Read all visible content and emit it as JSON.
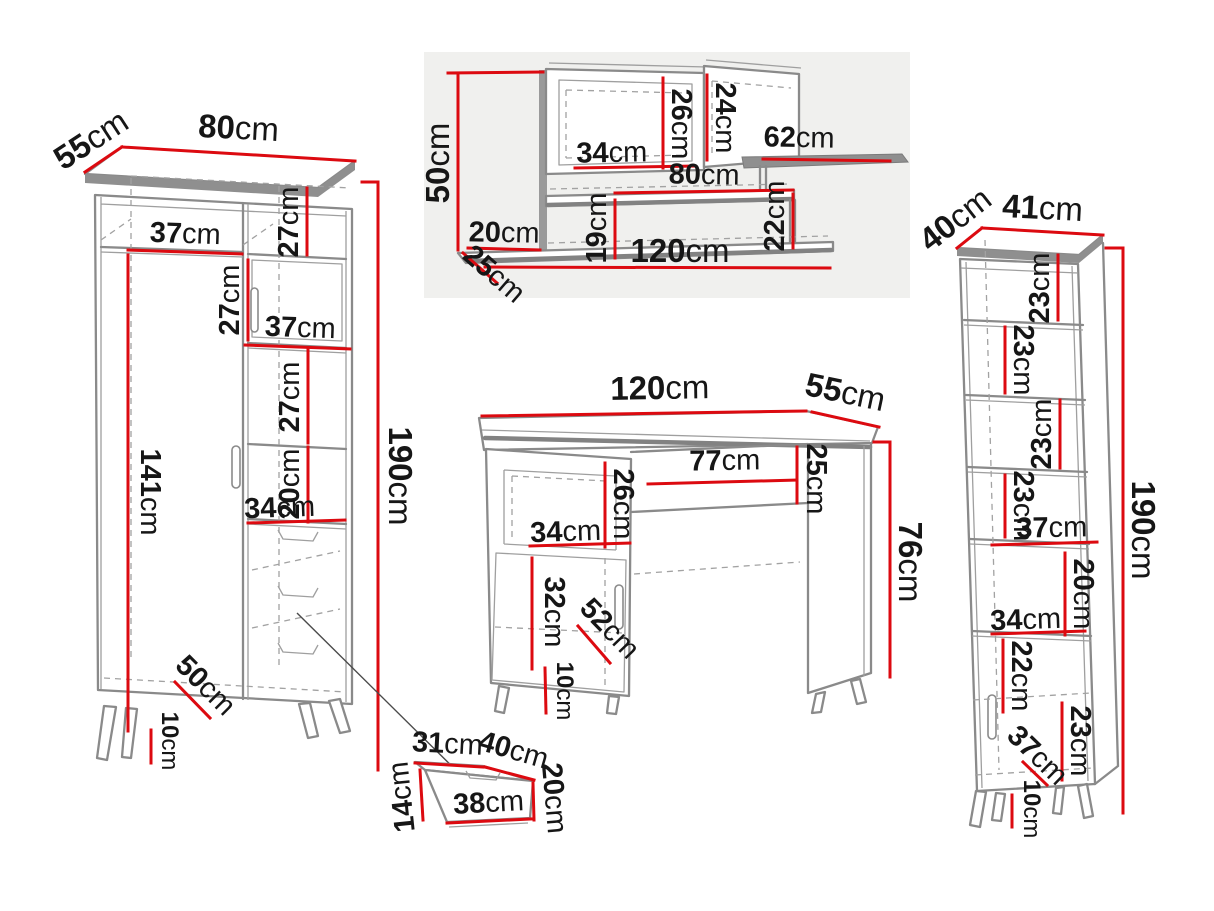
{
  "unit": "cm",
  "colors": {
    "dimension": "#dc0a10",
    "outline": "#8a8a8a",
    "text": "#161616",
    "background": "#ffffff"
  },
  "wardrobe": {
    "depth": "55",
    "width": "80",
    "height": "190",
    "shelf_top_width": "37",
    "top_right_section": "27",
    "mid_door_section": "27",
    "shelf_mid_width": "37",
    "lower_right_section": "27",
    "niche_height": "20",
    "niche_width": "34",
    "left_section_height": "141",
    "base_depth": "50",
    "leg_height": "10"
  },
  "wall_shelf": {
    "height": "50",
    "left_overhang": "20",
    "depth": "25",
    "cabinet_width": "34",
    "cabinet_height": "26",
    "right_cabinet_height": "24",
    "top_shelf_width": "62",
    "middle_shelf_width": "80",
    "left_gap_height": "19",
    "right_gap_height": "22",
    "total_width": "120"
  },
  "desk": {
    "width": "120",
    "depth": "55",
    "height": "76",
    "knee_width": "77",
    "rail_height": "25",
    "niche_height": "26",
    "niche_width": "34",
    "door_height": "32",
    "door_diagonal": "52",
    "leg_height": "10"
  },
  "bookcase": {
    "depth": "40",
    "width": "41",
    "height": "190",
    "section1": "23",
    "section2": "23",
    "section3": "23",
    "section4": "23",
    "shelf_width": "37",
    "niche_height": "20",
    "niche_width": "34",
    "below_niche": "22",
    "bottom_section": "23",
    "base_depth": "37",
    "leg_height": "10"
  },
  "drawer_box": {
    "top_width": "31",
    "top_depth": "40",
    "right_height": "20",
    "front_width": "38",
    "left_height": "14"
  }
}
